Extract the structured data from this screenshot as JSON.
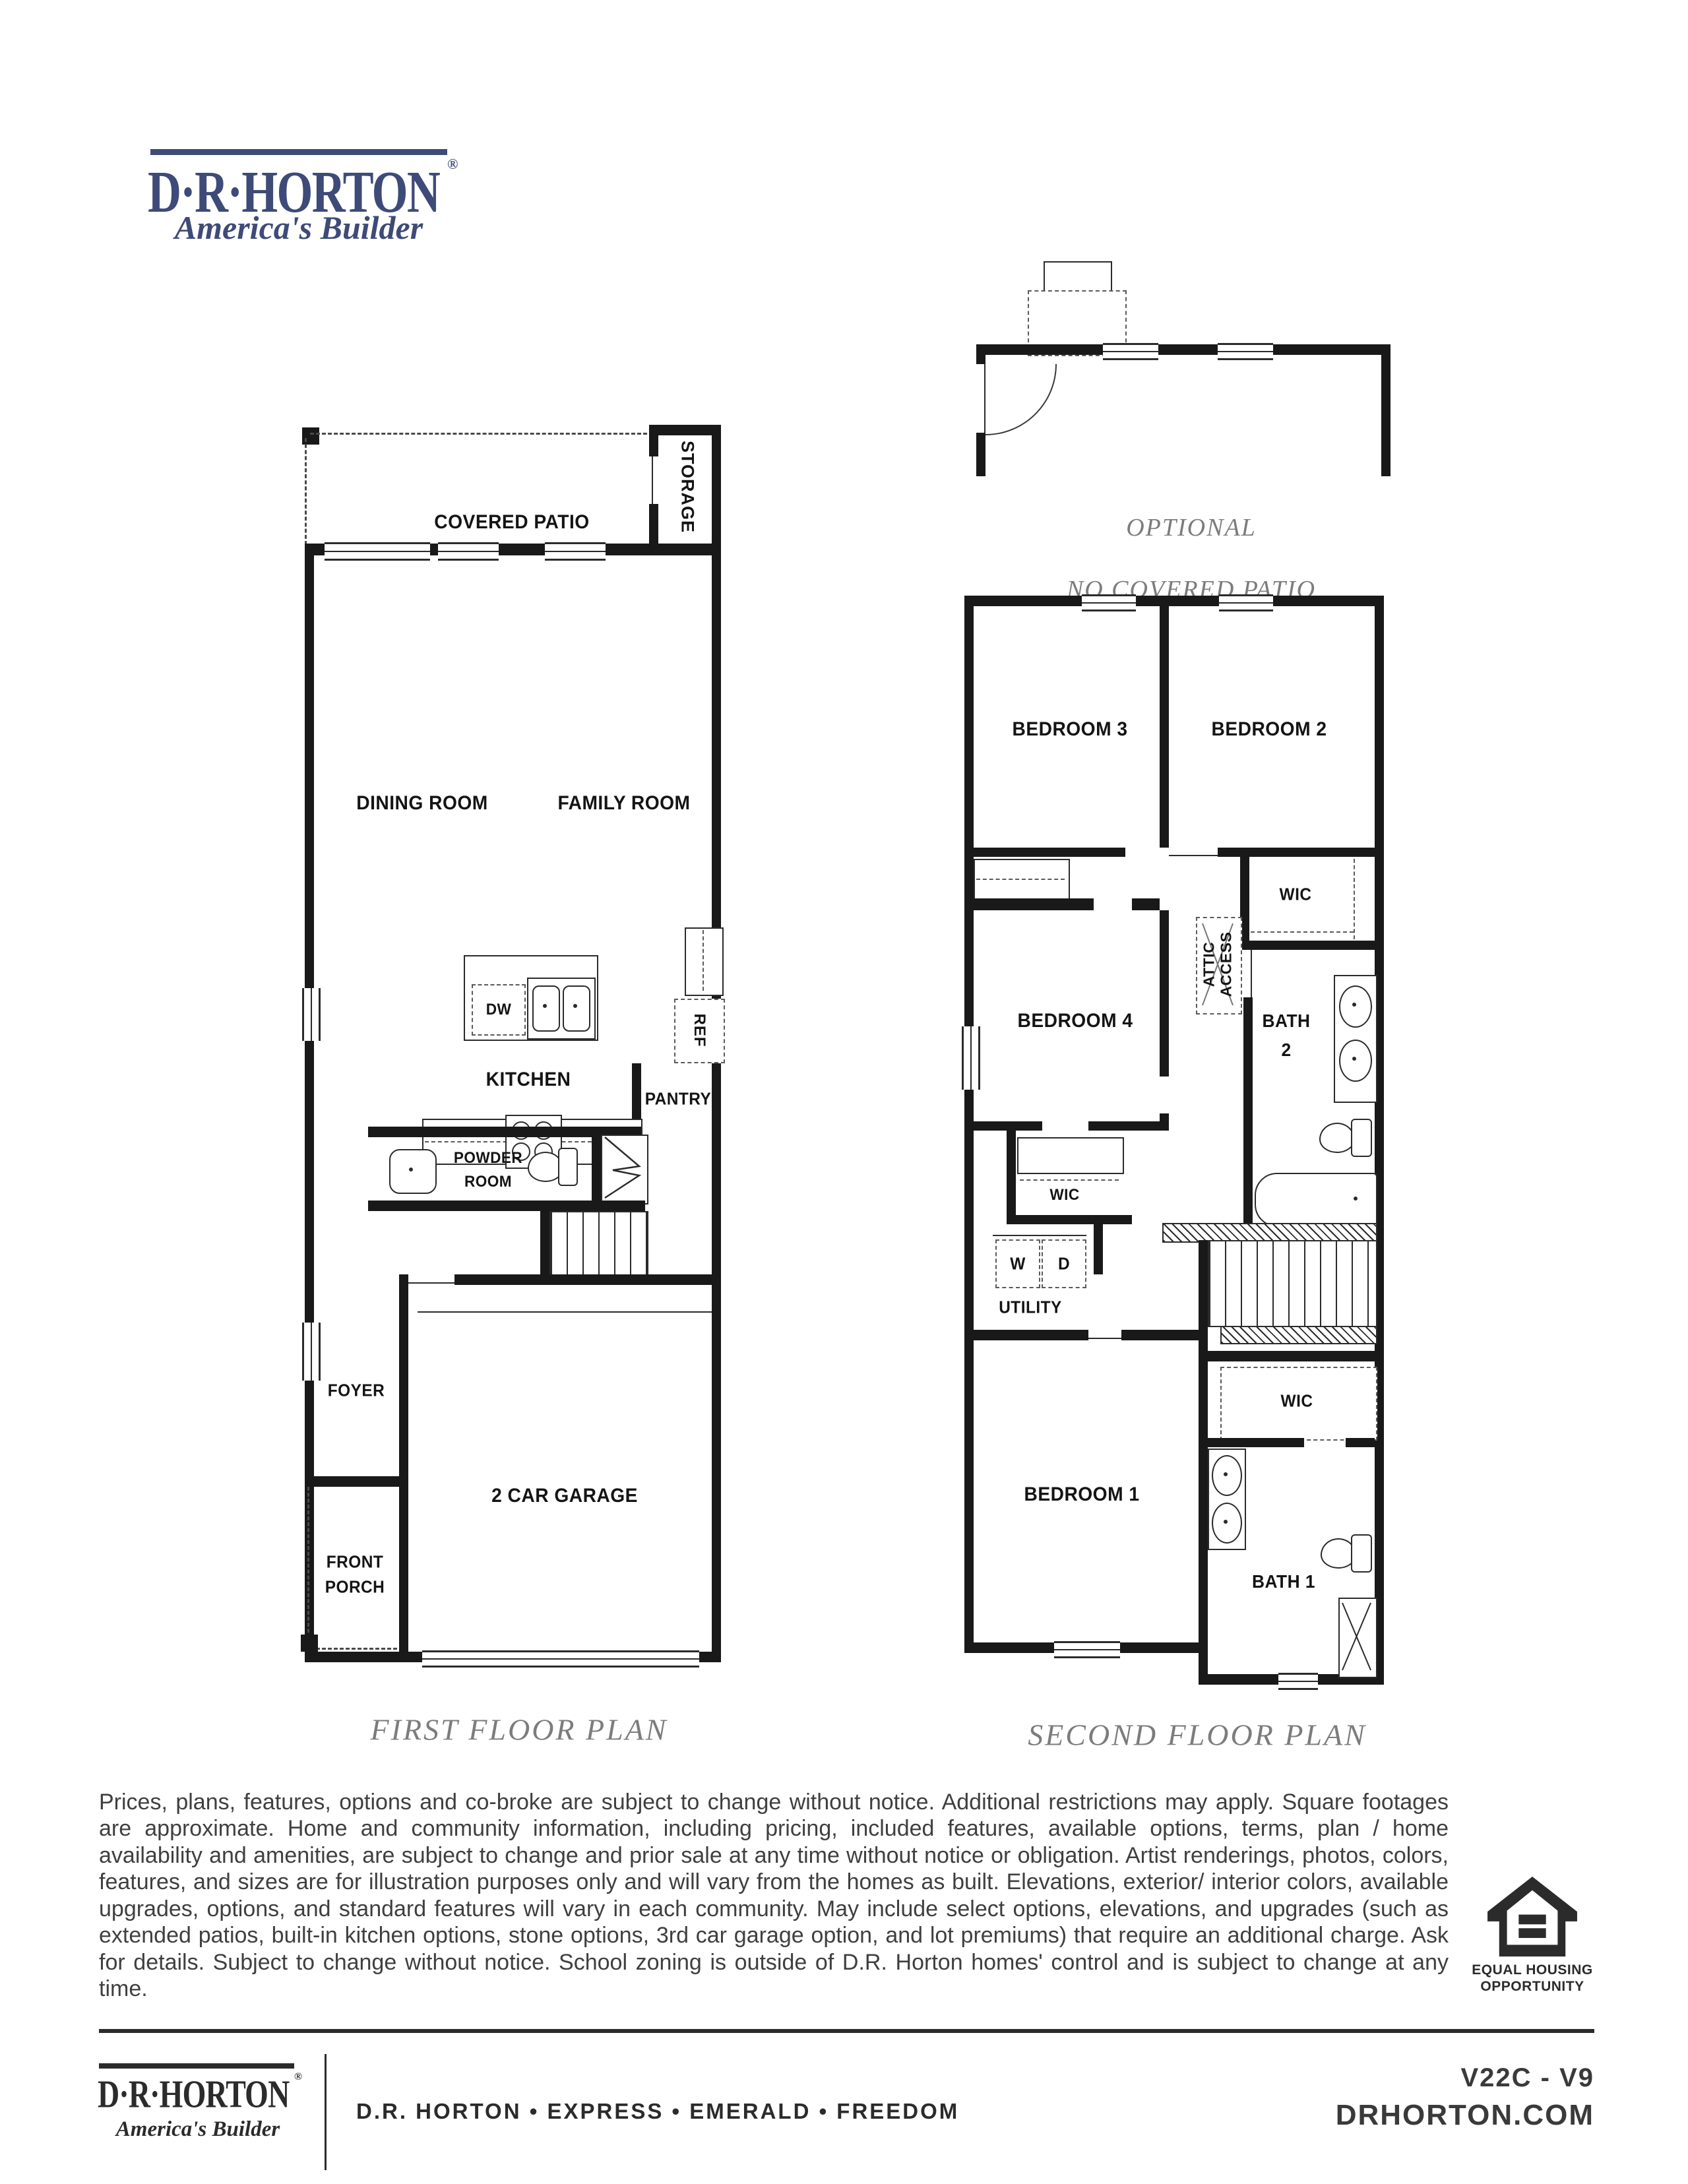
{
  "brand": {
    "name": "D·R·HORTON",
    "registered": "®",
    "tagline": "America's Builder",
    "navy": "#3e4b78"
  },
  "optional_detail": {
    "line1": "OPTIONAL",
    "line2": "NO COVERED PATIO"
  },
  "first_floor": {
    "caption": "FIRST FLOOR PLAN",
    "rooms": {
      "covered_patio": "COVERED PATIO",
      "storage": "STORAGE",
      "dining": "DINING ROOM",
      "family": "FAMILY ROOM",
      "kitchen": "KITCHEN",
      "dw": "DW",
      "ref": "REF",
      "pantry": "PANTRY",
      "powder_line1": "POWDER",
      "powder_line2": "ROOM",
      "foyer": "FOYER",
      "garage": "2 CAR GARAGE",
      "porch_line1": "FRONT",
      "porch_line2": "PORCH"
    }
  },
  "second_floor": {
    "caption": "SECOND FLOOR PLAN",
    "rooms": {
      "bedroom3": "BEDROOM 3",
      "bedroom2": "BEDROOM 2",
      "wic_bedroom2": "WIC",
      "attic_line1": "ATTIC",
      "attic_line2": "ACCESS",
      "bedroom4": "BEDROOM 4",
      "bath2_line1": "BATH",
      "bath2_line2": "2",
      "wic_bedroom4": "WIC",
      "washer": "W",
      "dryer": "D",
      "utility": "UTILITY",
      "wic_bedroom1": "WIC",
      "bedroom1": "BEDROOM 1",
      "bath1": "BATH 1"
    }
  },
  "disclaimer": "Prices, plans, features, options and co-broke are subject to change without notice. Additional restrictions may apply.  Square footages are approximate. Home and community information, including pricing, included features, available options, terms, plan / home availability and amenities, are subject to change and prior sale at any time without notice or obligation. Artist renderings, photos, colors, features, and sizes are for illustration purposes only and will vary from the homes as built. Elevations, exterior/ interior colors, available upgrades, options, and standard features will vary in each community. May include select options, elevations, and upgrades (such as extended patios, built-in kitchen options, stone options, 3rd car garage option, and lot premiums) that require an additional charge. Ask for details. Subject to change without notice. School zoning is outside of D.R. Horton homes' control and is subject to change at any time.",
  "eho": {
    "line1": "EQUAL HOUSING",
    "line2": "OPPORTUNITY"
  },
  "footer": {
    "brands": "D.R. HORTON • EXPRESS • EMERALD • FREEDOM",
    "plan_code": "V22C - V9",
    "website": "DRHORTON.COM"
  }
}
